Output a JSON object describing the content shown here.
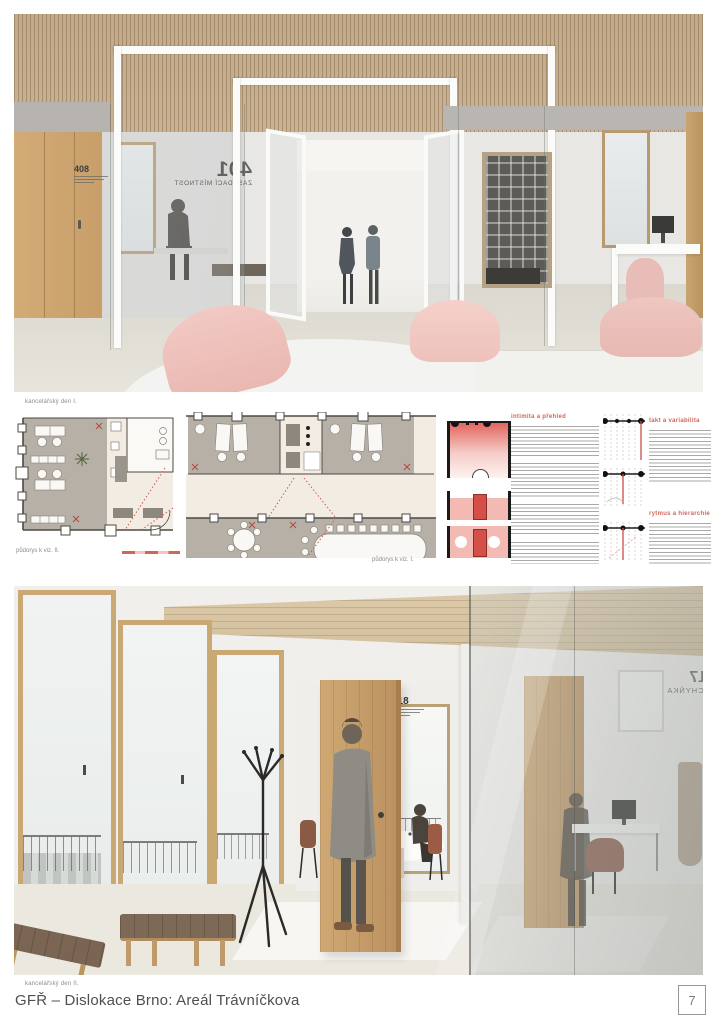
{
  "board": {
    "footer_title": "GFŘ – Dislokace Brno: Areál Trávníčkova",
    "page_number": "7"
  },
  "render_top": {
    "caption": "kancelářský den I.",
    "door_sign_number": "408",
    "glass_sign_number": "401",
    "glass_sign_label": "ZASEDACÍ MÍSTNOST"
  },
  "render_bottom": {
    "caption": "kancelářský den II.",
    "door_sign_number": "418",
    "glass_sign_number": "417",
    "glass_sign_label": "KUCHYŇKA"
  },
  "plans": {
    "left_caption": "půdorys k viz. II.",
    "right_caption": "půdorys k viz. I."
  },
  "concepts": {
    "items": [
      {
        "title": "intimita a přehled"
      },
      {
        "title": "takt a variabilita"
      },
      {
        "title": "rytmus a hierarchie"
      }
    ]
  },
  "colors": {
    "accent_red": "#d0655c",
    "wood": "#c9a873",
    "plan_carpet": "#b6b0a6",
    "plan_floor": "#f2ece2"
  }
}
